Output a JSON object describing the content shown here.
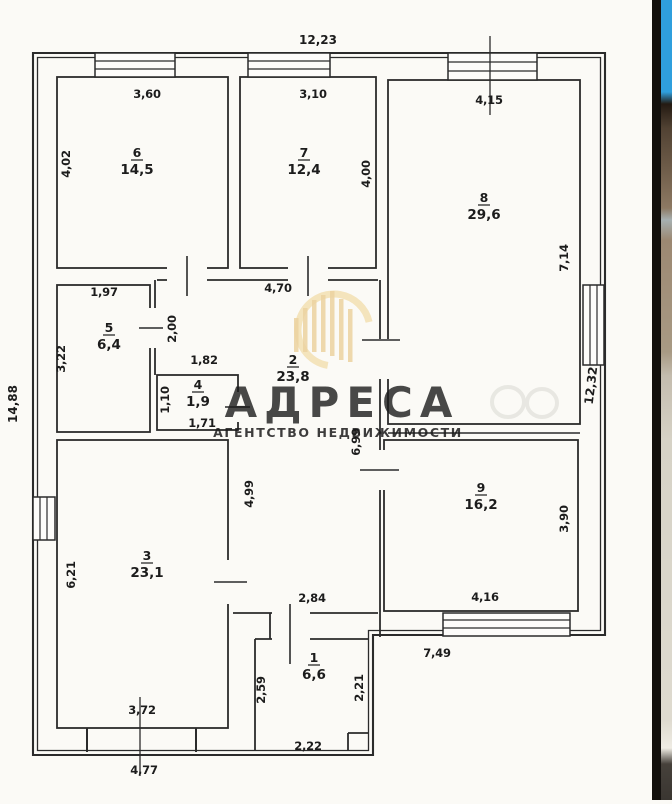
{
  "plan": {
    "overall": {
      "top": "12,23",
      "left": "14,88",
      "right": "12,32",
      "bottom_left": "4,77",
      "bottom_right": "7,49"
    },
    "rooms": {
      "r1": {
        "num": "1",
        "area": "6,6",
        "d_top": "2,84",
        "d_left": "2,59",
        "d_right": "2,21",
        "d_bottom": "2,22"
      },
      "r2": {
        "num": "2",
        "area": "23,8",
        "d_top": "4,70",
        "d_door": "2,00",
        "d_nook": "1,82",
        "d_left": "4,99",
        "d_right": "6,99"
      },
      "r3": {
        "num": "3",
        "area": "23,1",
        "d_left": "6,21",
        "d_bottom": "3,72"
      },
      "r4": {
        "num": "4",
        "area": "1,9",
        "d_left": "1,10",
        "d_bottom": "1,71"
      },
      "r5": {
        "num": "5",
        "area": "6,4",
        "d_top": "1,97",
        "d_left": "3,22"
      },
      "r6": {
        "num": "6",
        "area": "14,5",
        "d_top": "3,60",
        "d_left": "4,02"
      },
      "r7": {
        "num": "7",
        "area": "12,4",
        "d_top": "3,10",
        "d_right": "4,00"
      },
      "r8": {
        "num": "8",
        "area": "29,6",
        "d_top": "4,15",
        "d_right": "7,14"
      },
      "r9": {
        "num": "9",
        "area": "16,2",
        "d_right": "3,90",
        "d_bottom": "4,16"
      }
    }
  },
  "watermark": {
    "brand": "АДРЕСА",
    "tagline": "АГЕНТСТВО НЕДВИЖИМОСТИ",
    "brand_color": "#e6be7d",
    "tagline_color": "#eeD2a0",
    "logo_color": "#f1dbab"
  }
}
